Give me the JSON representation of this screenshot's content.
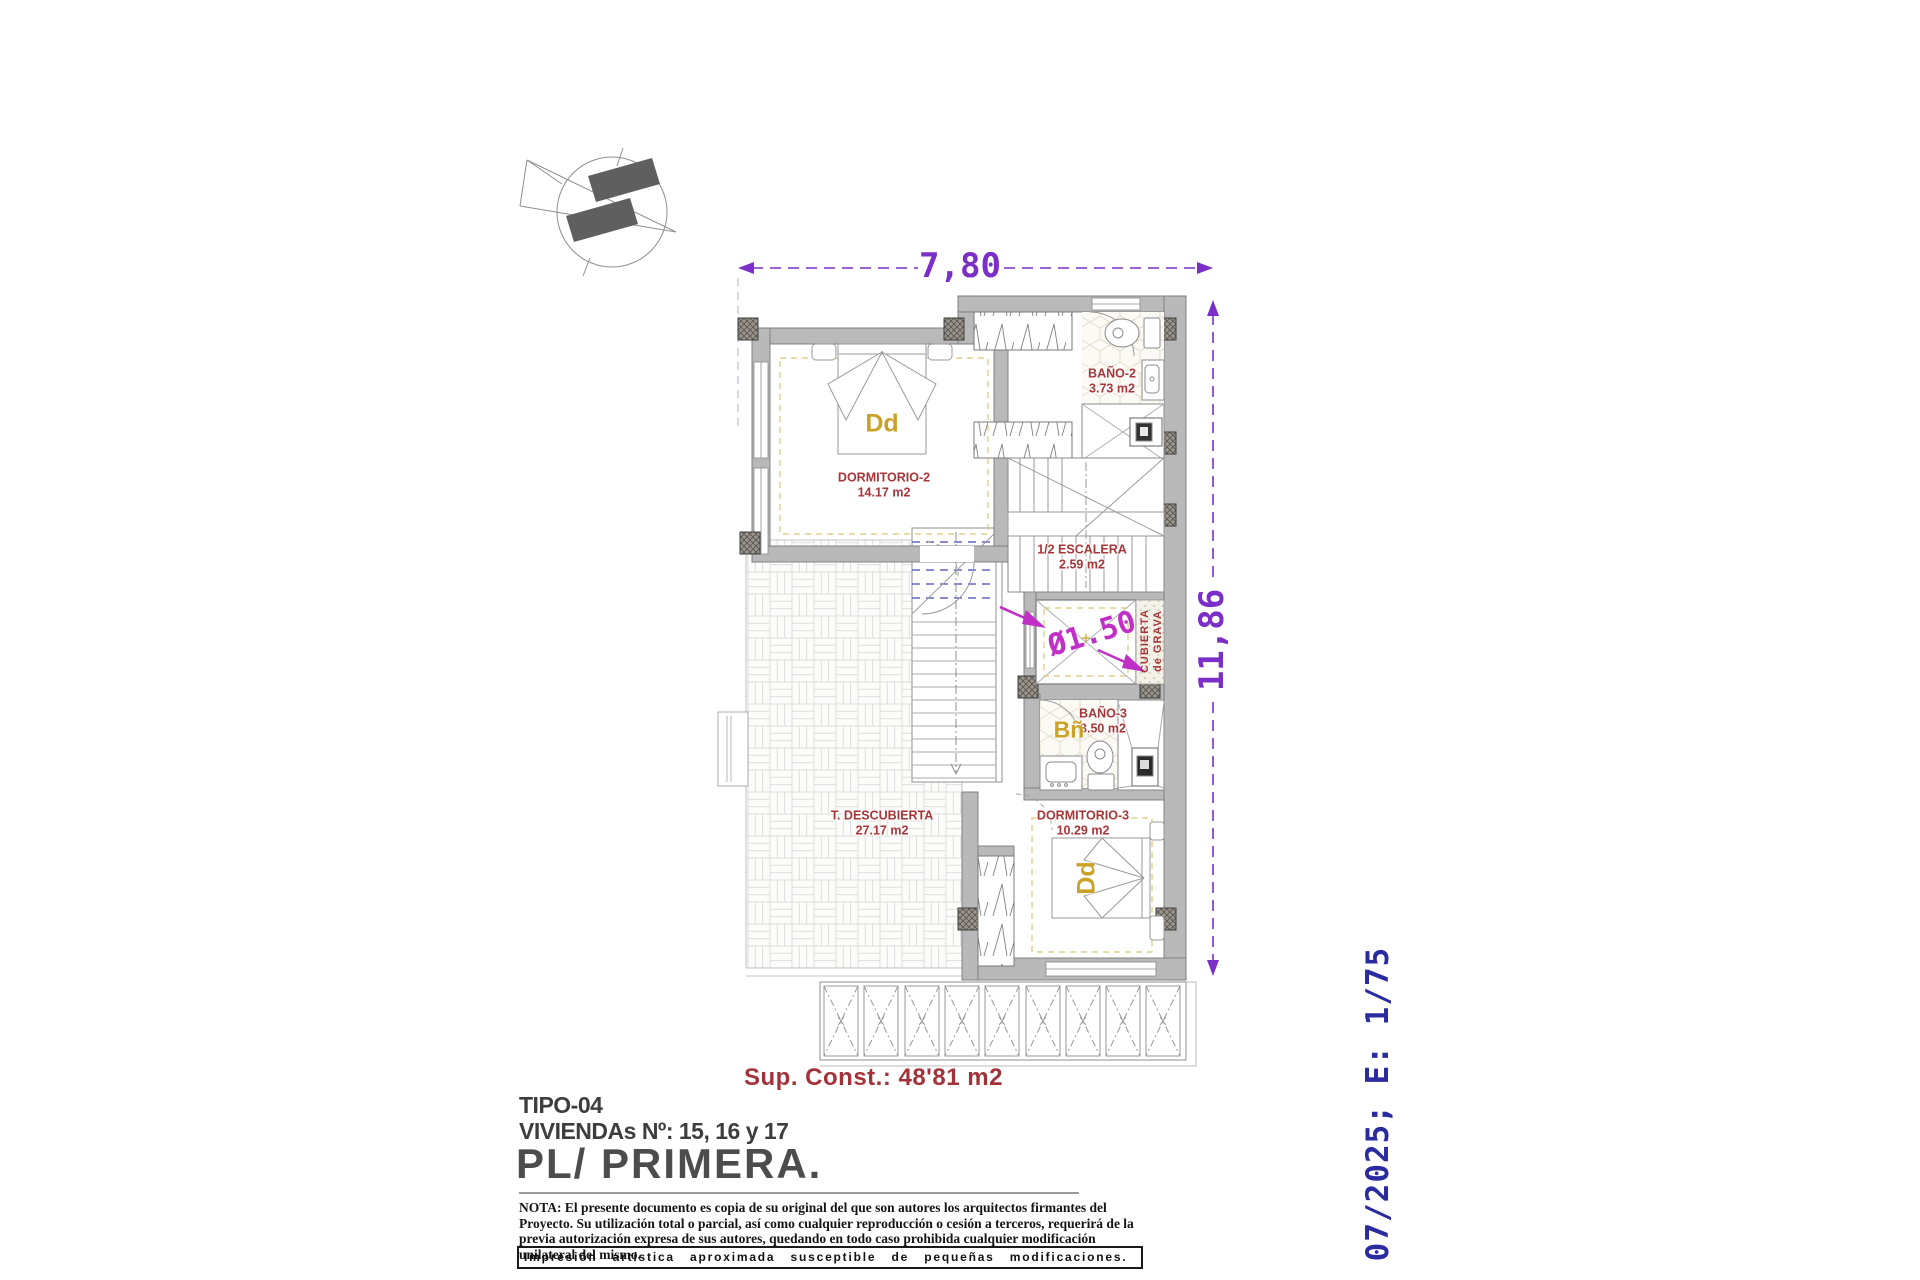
{
  "colors": {
    "dimension_purple": "#7B2FC8",
    "annotation_magenta": "#C030C6",
    "room_label_red": "#A83538",
    "tag_gold": "#C9A227",
    "stamp_navy": "#2B2BA0",
    "wall_gray": "#B9B9B9"
  },
  "icons": {
    "compass": "north-arrow-compass"
  },
  "dimensions": {
    "width": "7,80",
    "height": "11,86",
    "shaft_diameter": "Ø1.50"
  },
  "annotations": {
    "roof": {
      "line1": "CUBIERTA",
      "line2": "de GRAVA"
    },
    "bed_tag": "Dd",
    "bath_tag": "Bñ"
  },
  "rooms": [
    {
      "name": "DORMITORIO-2",
      "area": "14.17 m2"
    },
    {
      "name": "BAÑO-2",
      "area": "3.73 m2"
    },
    {
      "name": "1/2 ESCALERA",
      "area": "2.59 m2"
    },
    {
      "name": "BAÑO-3",
      "area": "3.50 m2"
    },
    {
      "name": "DORMITORIO-3",
      "area": "10.29 m2"
    },
    {
      "name": "T. DESCUBIERTA",
      "area": "27.17 m2"
    }
  ],
  "summary": {
    "built_area": "Sup. Const.: 48'81 m2"
  },
  "title_block": {
    "type": "TIPO-04",
    "units": "VIVIENDAs Nº: 15, 16 y 17",
    "floor": "PL/ PRIMERA.",
    "note": "NOTA: El presente documento es copia de su original del que son autores los arquitectos firmantes del Proyecto. Su utilización total o parcial, así como cualquier reproducción o cesión a terceros, requerirá  de la previa autorización expresa de sus autores, quedando en todo caso prohibida cualquier modificación unilateral del mismo.",
    "disclaimer": "Impresión artística aproximada susceptible de pequeñas modificaciones.",
    "date_scale": "07/2025; E: 1/75"
  }
}
